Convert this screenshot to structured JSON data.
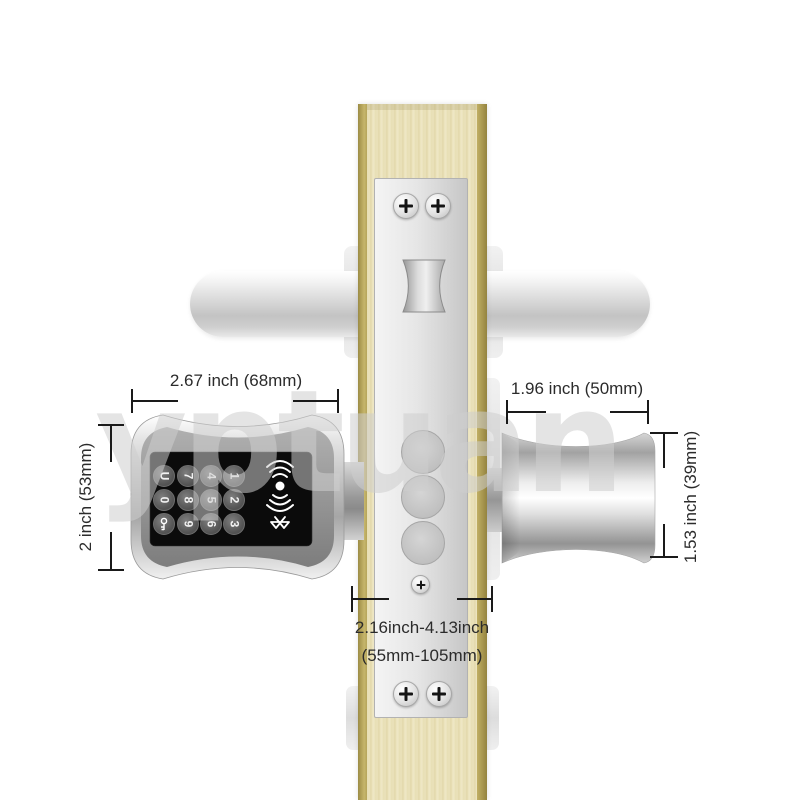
{
  "watermark": "yptuan",
  "annotations": {
    "keypad_width": "2.67 inch (68mm)",
    "keypad_height": "2 inch (53mm)",
    "knob_width": "1.96 inch (50mm)",
    "knob_height": "1.53 inch (39mm)",
    "door_range_line1": "2.16inch-4.13inch",
    "door_range_line2": "(55mm-105mm)"
  },
  "keypad": {
    "rows": [
      [
        "U",
        "7",
        "4",
        "1"
      ],
      [
        "0",
        "8",
        "5",
        "2"
      ],
      [
        "key",
        "9",
        "6",
        "3"
      ]
    ],
    "side_icons": [
      "rfid-reader",
      "bluetooth"
    ]
  },
  "colors": {
    "wood": "#e9e0b6",
    "wood_edge_gold": "#b1a054",
    "chrome_light": "#f5f5f5",
    "chrome_dark": "#9a9a9a",
    "keypad_panel": "#0b0b0b",
    "dimension_line": "#1a1a1a",
    "watermark_gray": "#cdcdcd"
  }
}
